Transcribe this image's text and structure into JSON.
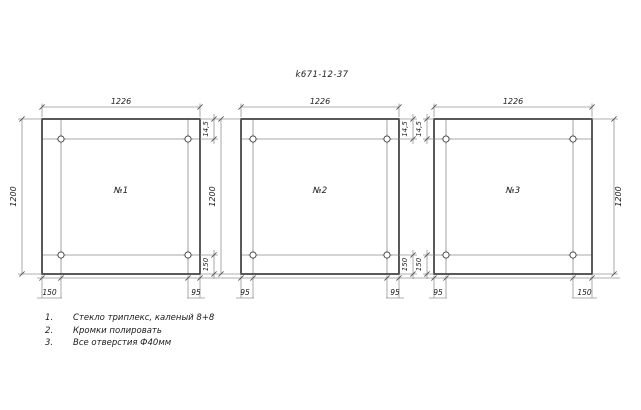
{
  "drawing": {
    "title": "k671-12-37",
    "colors": {
      "outline": "#3e3e3e",
      "thin": "#8c8c8c",
      "dim": "#949494",
      "tick": "#555555",
      "text": "#1b1b1b"
    },
    "panels": [
      {
        "label": "№1",
        "width_dim": "1226",
        "height_dim": "1200",
        "hole_top_offset": "14,5",
        "hole_bottom_offset": "150",
        "hole_left_offset": "150",
        "hole_right_offset": "95"
      },
      {
        "label": "№2",
        "width_dim": "1226",
        "height_dim": "1200",
        "hole_top_offset": "14,5",
        "hole_bottom_offset": "150",
        "hole_left_offset": "95",
        "hole_right_offset": "95"
      },
      {
        "label": "№3",
        "width_dim": "1226",
        "height_dim": "1200",
        "hole_top_offset": "14,5",
        "hole_bottom_offset": "150",
        "hole_left_offset": "95",
        "hole_right_offset": "150"
      }
    ],
    "notes": [
      {
        "num": "1.",
        "text": "Стекло триплекс, каленый 8+8"
      },
      {
        "num": "2.",
        "text": "Кромки полировать"
      },
      {
        "num": "3.",
        "text": "Все отверстия Ф40мм"
      }
    ]
  }
}
